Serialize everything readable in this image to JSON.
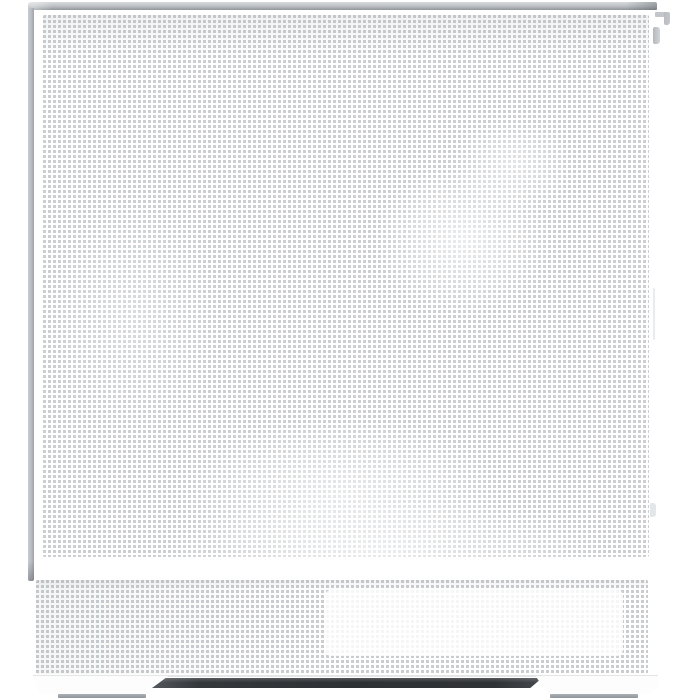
{
  "meta": {
    "description": "Straight-on product photo of a white mid-tower PC case with a fine perforated mesh front panel, silver top rail, bottom mesh vent strip with a recessed white plate, two white feet with gray rubber pads and a dark shadow underneath"
  },
  "colors": {
    "bg": "#ffffff",
    "mesh-dot": "#c5c8cb",
    "mesh-gap": "#ffffff",
    "rail-light": "#d7dadd",
    "rail-mid": "#b6babe",
    "rail-dark": "#8f9498",
    "frame-light": "#c9ccd0",
    "frame-dark": "#9fa3a7",
    "tab": "#c3c7cb",
    "edge-line": "#e3e5e7",
    "plate-white": "#ffffff",
    "pad-light": "#abb0b4",
    "pad-dark": "#8f959a",
    "shadow-dark": "#2e3134",
    "shadow-mid": "#44484c"
  },
  "case": {
    "parts": {
      "top_rail": "silver top rail",
      "rear_latch_bracket": "rear latch bracket",
      "side_panel_tab": "side panel tab",
      "left_frame": "left frame edge",
      "front_mesh": "perforated mesh front panel",
      "bottom_strip": "bottom mesh vent strip",
      "vent_plate": "recessed bottom plate",
      "left_foot": "left foot",
      "right_foot": "right foot",
      "under_shadow": "shadow under case"
    }
  }
}
